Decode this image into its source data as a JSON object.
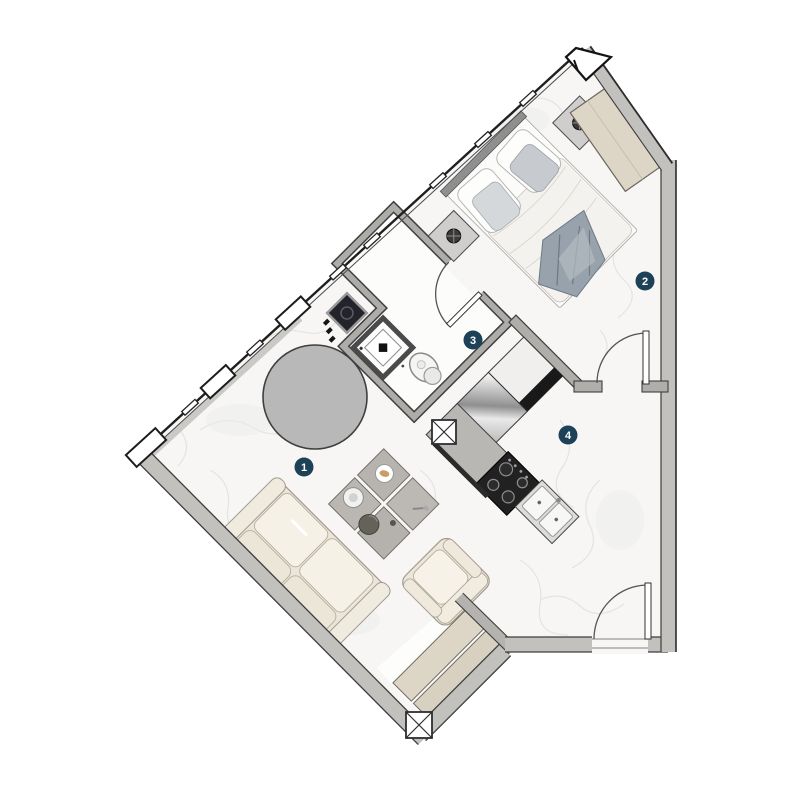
{
  "plan": {
    "rooms": [
      {
        "number": "1"
      },
      {
        "number": "2"
      },
      {
        "number": "3"
      },
      {
        "number": "4"
      }
    ],
    "colors": {
      "badge": "#1d4257",
      "wall": "#c3c1be",
      "interior_wall": "#b0aeab",
      "floor": "#f7f6f5",
      "beige_furniture": "#ddd5c5",
      "cream_sofa": "#ebe6d9",
      "table_gray": "#b8b8b8",
      "appliance_dark": "#212121"
    }
  }
}
